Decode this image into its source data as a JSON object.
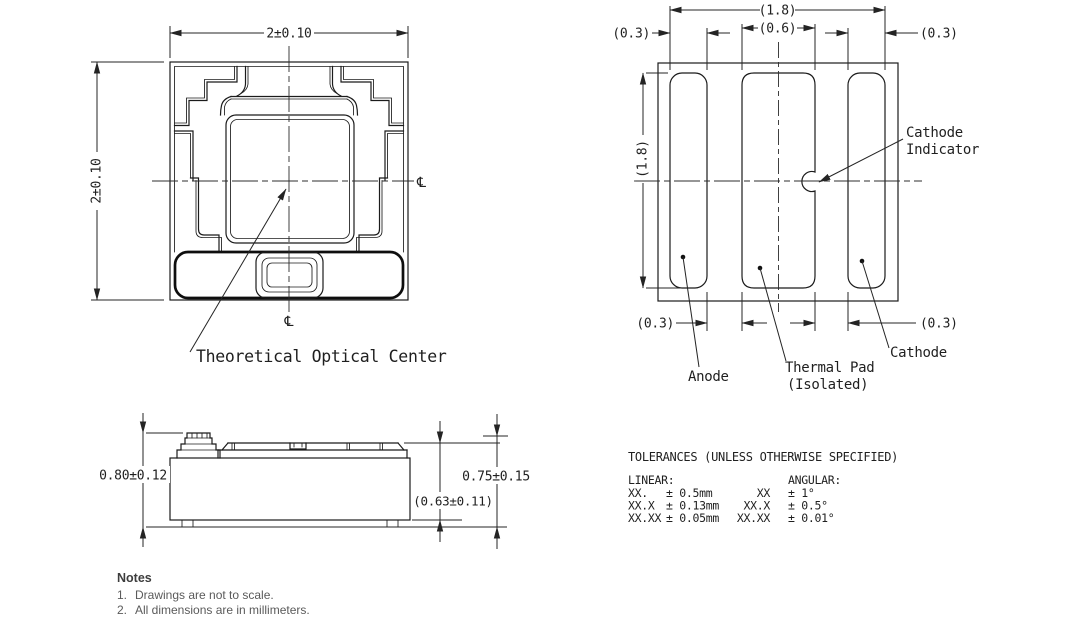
{
  "top_view": {
    "dim_width": "2±0.10",
    "dim_height": "2±0.10",
    "centerline_symbol": "℄",
    "optical_center_label": "Theoretical Optical Center"
  },
  "bottom_view": {
    "dims": {
      "span": "(1.8)",
      "height": "(1.8)",
      "center_pad": "(0.6)",
      "pad_left": "(0.3)",
      "pad_right": "(0.3)",
      "gap_left": "(0.3)",
      "gap_right": "(0.3)"
    },
    "labels": {
      "cathode_indicator_line1": "Cathode",
      "cathode_indicator_line2": "Indicator",
      "anode": "Anode",
      "thermal_pad_line1": "Thermal Pad",
      "thermal_pad_line2": "(Isolated)",
      "cathode": "Cathode"
    }
  },
  "side_view": {
    "dims": {
      "height_total": "0.80±0.12",
      "height_outer": "0.75±0.15",
      "height_inner": "(0.63±0.11)"
    }
  },
  "tolerances": {
    "title": "TOLERANCES (UNLESS OTHERWISE SPECIFIED)",
    "linear_heading": "LINEAR:",
    "angular_heading": "ANGULAR:",
    "linear": [
      {
        "code": "XX.",
        "tol": "± 0.5mm"
      },
      {
        "code": "XX.X",
        "tol": "± 0.13mm"
      },
      {
        "code": "XX.XX",
        "tol": "± 0.05mm"
      }
    ],
    "angular": [
      {
        "code": "XX",
        "tol": "± 1°"
      },
      {
        "code": "XX.X",
        "tol": "± 0.5°"
      },
      {
        "code": "XX.XX",
        "tol": "± 0.01°"
      }
    ]
  },
  "notes": {
    "heading": "Notes",
    "items": [
      {
        "num": "1.",
        "text": "Drawings are not to scale."
      },
      {
        "num": "2.",
        "text": "All dimensions are in millimeters."
      }
    ]
  }
}
